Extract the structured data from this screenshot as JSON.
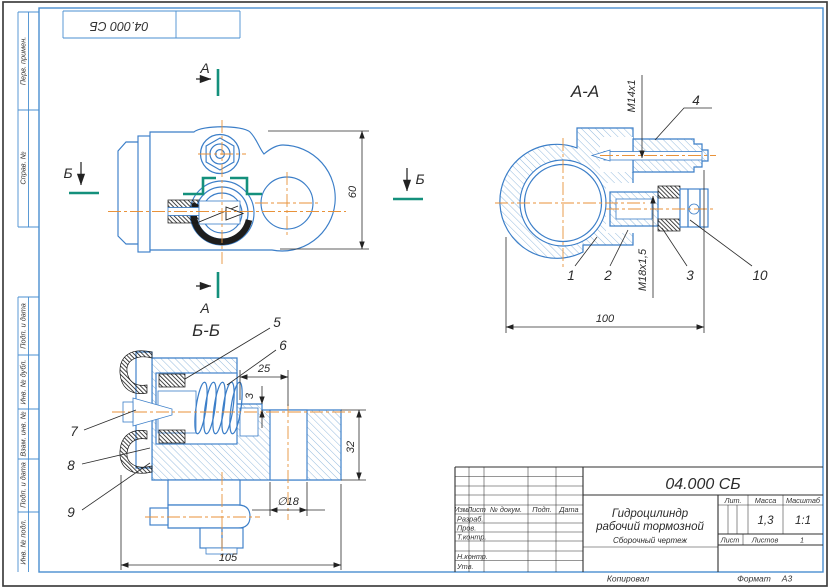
{
  "corner_stamp": {
    "doc_number": "04.000 СБ"
  },
  "frame_columns": {
    "top": [
      "Перв. примен.",
      "Справ. №"
    ],
    "bottom": [
      "Подп. и дата",
      "Инв. № дубл.",
      "Взам. инв. №",
      "Подп. и дата",
      "Инв. № подл."
    ]
  },
  "views": {
    "main": {
      "section_a": "А",
      "section_b": "Б",
      "dim_height": "60"
    },
    "aa": {
      "title": "А-А",
      "thread_top": "М14х1",
      "thread_bottom": "М18х1,5",
      "dim_width": "100",
      "callout_1": "1",
      "callout_2": "2",
      "callout_3": "3",
      "callout_4": "4",
      "callout_10": "10"
    },
    "bb": {
      "title": "Б-Б",
      "dim_25": "25",
      "dim_3": "3",
      "dim_32": "32",
      "dim_d18": "∅18",
      "dim_105": "105",
      "callout_5": "5",
      "callout_6": "6",
      "callout_7": "7",
      "callout_8": "8",
      "callout_9": "9"
    }
  },
  "title_block": {
    "doc_number": "04.000 СБ",
    "product_title_line1": "Гидроцилиндр",
    "product_title_line2": "рабочий тормозной",
    "doc_type": "Сборочный чертеж",
    "header_izm": "Изм.",
    "header_list": "Лист",
    "header_doc": "№ докум.",
    "header_podp": "Подп.",
    "header_data": "Дата",
    "row_razrab": "Разраб.",
    "row_prov": "Пров.",
    "row_tkontr": "Т.контр.",
    "row_nkontr": "Н.контр.",
    "row_utv": "Утв.",
    "lit_label": "Лит.",
    "massa_label": "Масса",
    "masshtab_label": "Масштаб",
    "massa_value": "1,3",
    "masshtab_value": "1:1",
    "list_label": "Лист",
    "listov_label": "Листов",
    "listov_value": "1"
  },
  "footer": {
    "kopiroval": "Копировал",
    "format_label": "Формат",
    "format_value": "А3"
  },
  "colors": {
    "drawing_blue": "#3b7ec8",
    "centerline_orange": "#e8923a",
    "section_plane_teal": "#14907c",
    "ink": "#2b2b2b",
    "frame_blue": "#4a8fd0"
  }
}
